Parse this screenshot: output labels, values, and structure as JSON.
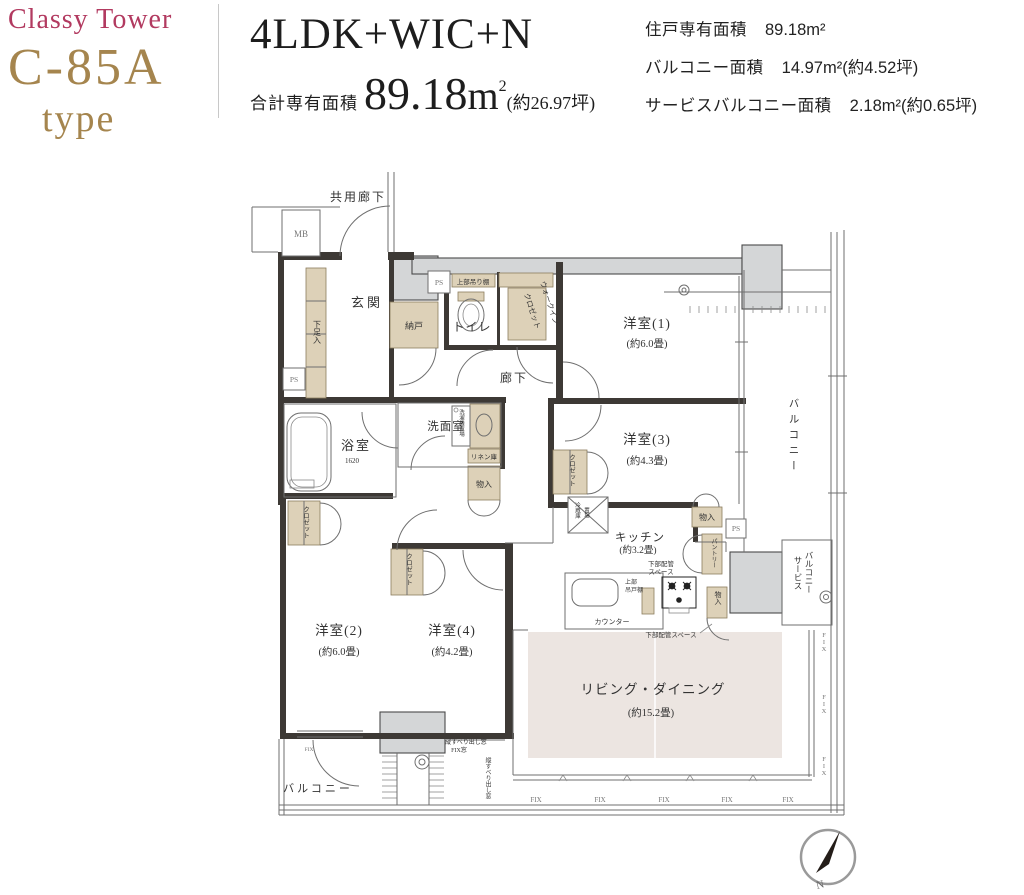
{
  "header": {
    "brand": {
      "line1": "Classy Tower",
      "line2": "C-85A",
      "line3": "type"
    },
    "plan_type": "4LDK+WIC+N",
    "total_area": {
      "label": "合計専有面積",
      "value": "89.18",
      "unit": "m",
      "sup": "2",
      "tsubo": "(約26.97坪)"
    },
    "specs": [
      {
        "label": "住戸専有面積",
        "value": "89.18m²"
      },
      {
        "label": "バルコニー面積",
        "value": "14.97m²(約4.52坪)"
      },
      {
        "label": "サービスバルコニー面積",
        "value": "2.18m²(約0.65坪)"
      }
    ]
  },
  "floorplan": {
    "common_corridor": "共用廊下",
    "mb": "MB",
    "ps": "PS",
    "genkan": "玄関",
    "shoe_box": "下足入",
    "nando": "納戸",
    "toilet": "トイレ",
    "toilet_shelf": "上部吊り棚",
    "wic_l1": "ウォークイン",
    "wic_l2": "クロゼット",
    "hallway": "廊下",
    "room1": "洋室(1)",
    "room1_size": "(約6.0畳)",
    "room3": "洋室(3)",
    "room3_size": "(約4.3畳)",
    "room2": "洋室(2)",
    "room2_size": "(約6.0畳)",
    "room4": "洋室(4)",
    "room4_size": "(約4.2畳)",
    "living": "リビング・ダイニング",
    "living_size": "(約15.2畳)",
    "kitchen": "キッチン",
    "kitchen_size": "(約3.2畳)",
    "bath": "浴室",
    "bath_size": "1620",
    "senmen": "洗面室",
    "washer": "洗濯機置場",
    "linen": "リネン庫",
    "storage": "物入",
    "closet": "クロゼット",
    "fridge_l1": "冷蔵庫",
    "fridge_l2": "置場",
    "pantry": "パントリー",
    "counter": "カウンター",
    "pipe_space_l1": "下部配管",
    "pipe_space_l2": "スペース",
    "pipe_space": "下部配管スペース",
    "hanging_cabinet_l1": "上部",
    "hanging_cabinet_l2": "吊戸棚",
    "balcony": "バルコニー",
    "service_balcony_l1": "サービス",
    "service_balcony_l2": "バルコニー",
    "fix": "FIX",
    "window_note_l1": "縦すべり出し窓",
    "window_note_l2": "FIX窓",
    "window_note_v": "縦すべり出し窓"
  },
  "compass": {
    "north": "N"
  },
  "colors": {
    "brand_pink": "#b23a60",
    "brand_gold": "#a5854e",
    "wall": "#3d3935",
    "cabinet_tan": "#ddd1b8",
    "concrete_gray": "#d4d6d7",
    "living_floor": "#ece5e1"
  }
}
